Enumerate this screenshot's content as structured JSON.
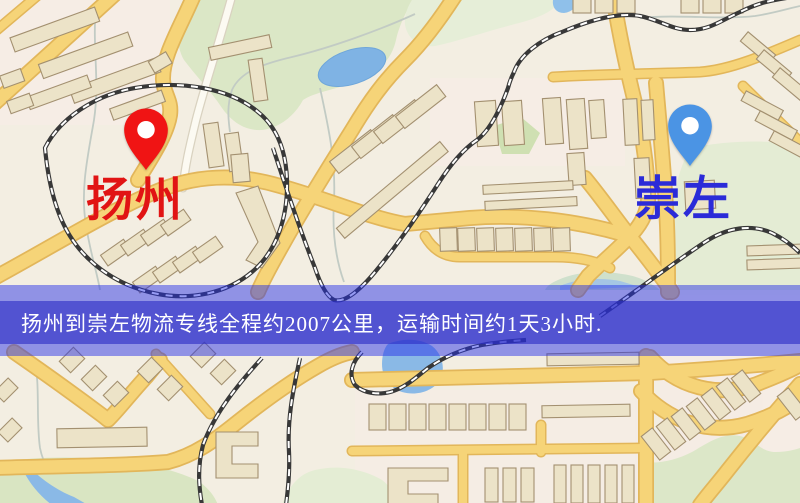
{
  "route": {
    "origin": "扬州",
    "destination": "崇左",
    "distance_text": "约2007公里",
    "duration_text": "约1天3小时",
    "summary": "扬州到崇左物流专线全程约2007公里，运输时间约1天3小时."
  },
  "markers": {
    "origin": {
      "label": "扬州",
      "pin_color": "#f01414",
      "label_color": "#e11414"
    },
    "destination": {
      "label": "崇左",
      "pin_color": "#4b94e4",
      "label_color": "#2b2bd8"
    }
  },
  "banner": {
    "text": "扬州到崇左物流专线全程约2007公里，运输时间约1天3小时.",
    "overlay_color": "#7a7ce0",
    "band_color": "#5355d0",
    "text_color": "#ffffff"
  },
  "map": {
    "type": "street-map",
    "theme_colors": {
      "background": "#f3eee2",
      "road_fill": "#f6d478",
      "road_casing": "#e2b65a",
      "building_fill": "#ece3c8",
      "building_outline": "#a39070",
      "park_green": "#dbe7c6",
      "water_blue": "#85b7e6",
      "railway_dark": "#383838",
      "railway_dash": "#ffffff"
    }
  }
}
